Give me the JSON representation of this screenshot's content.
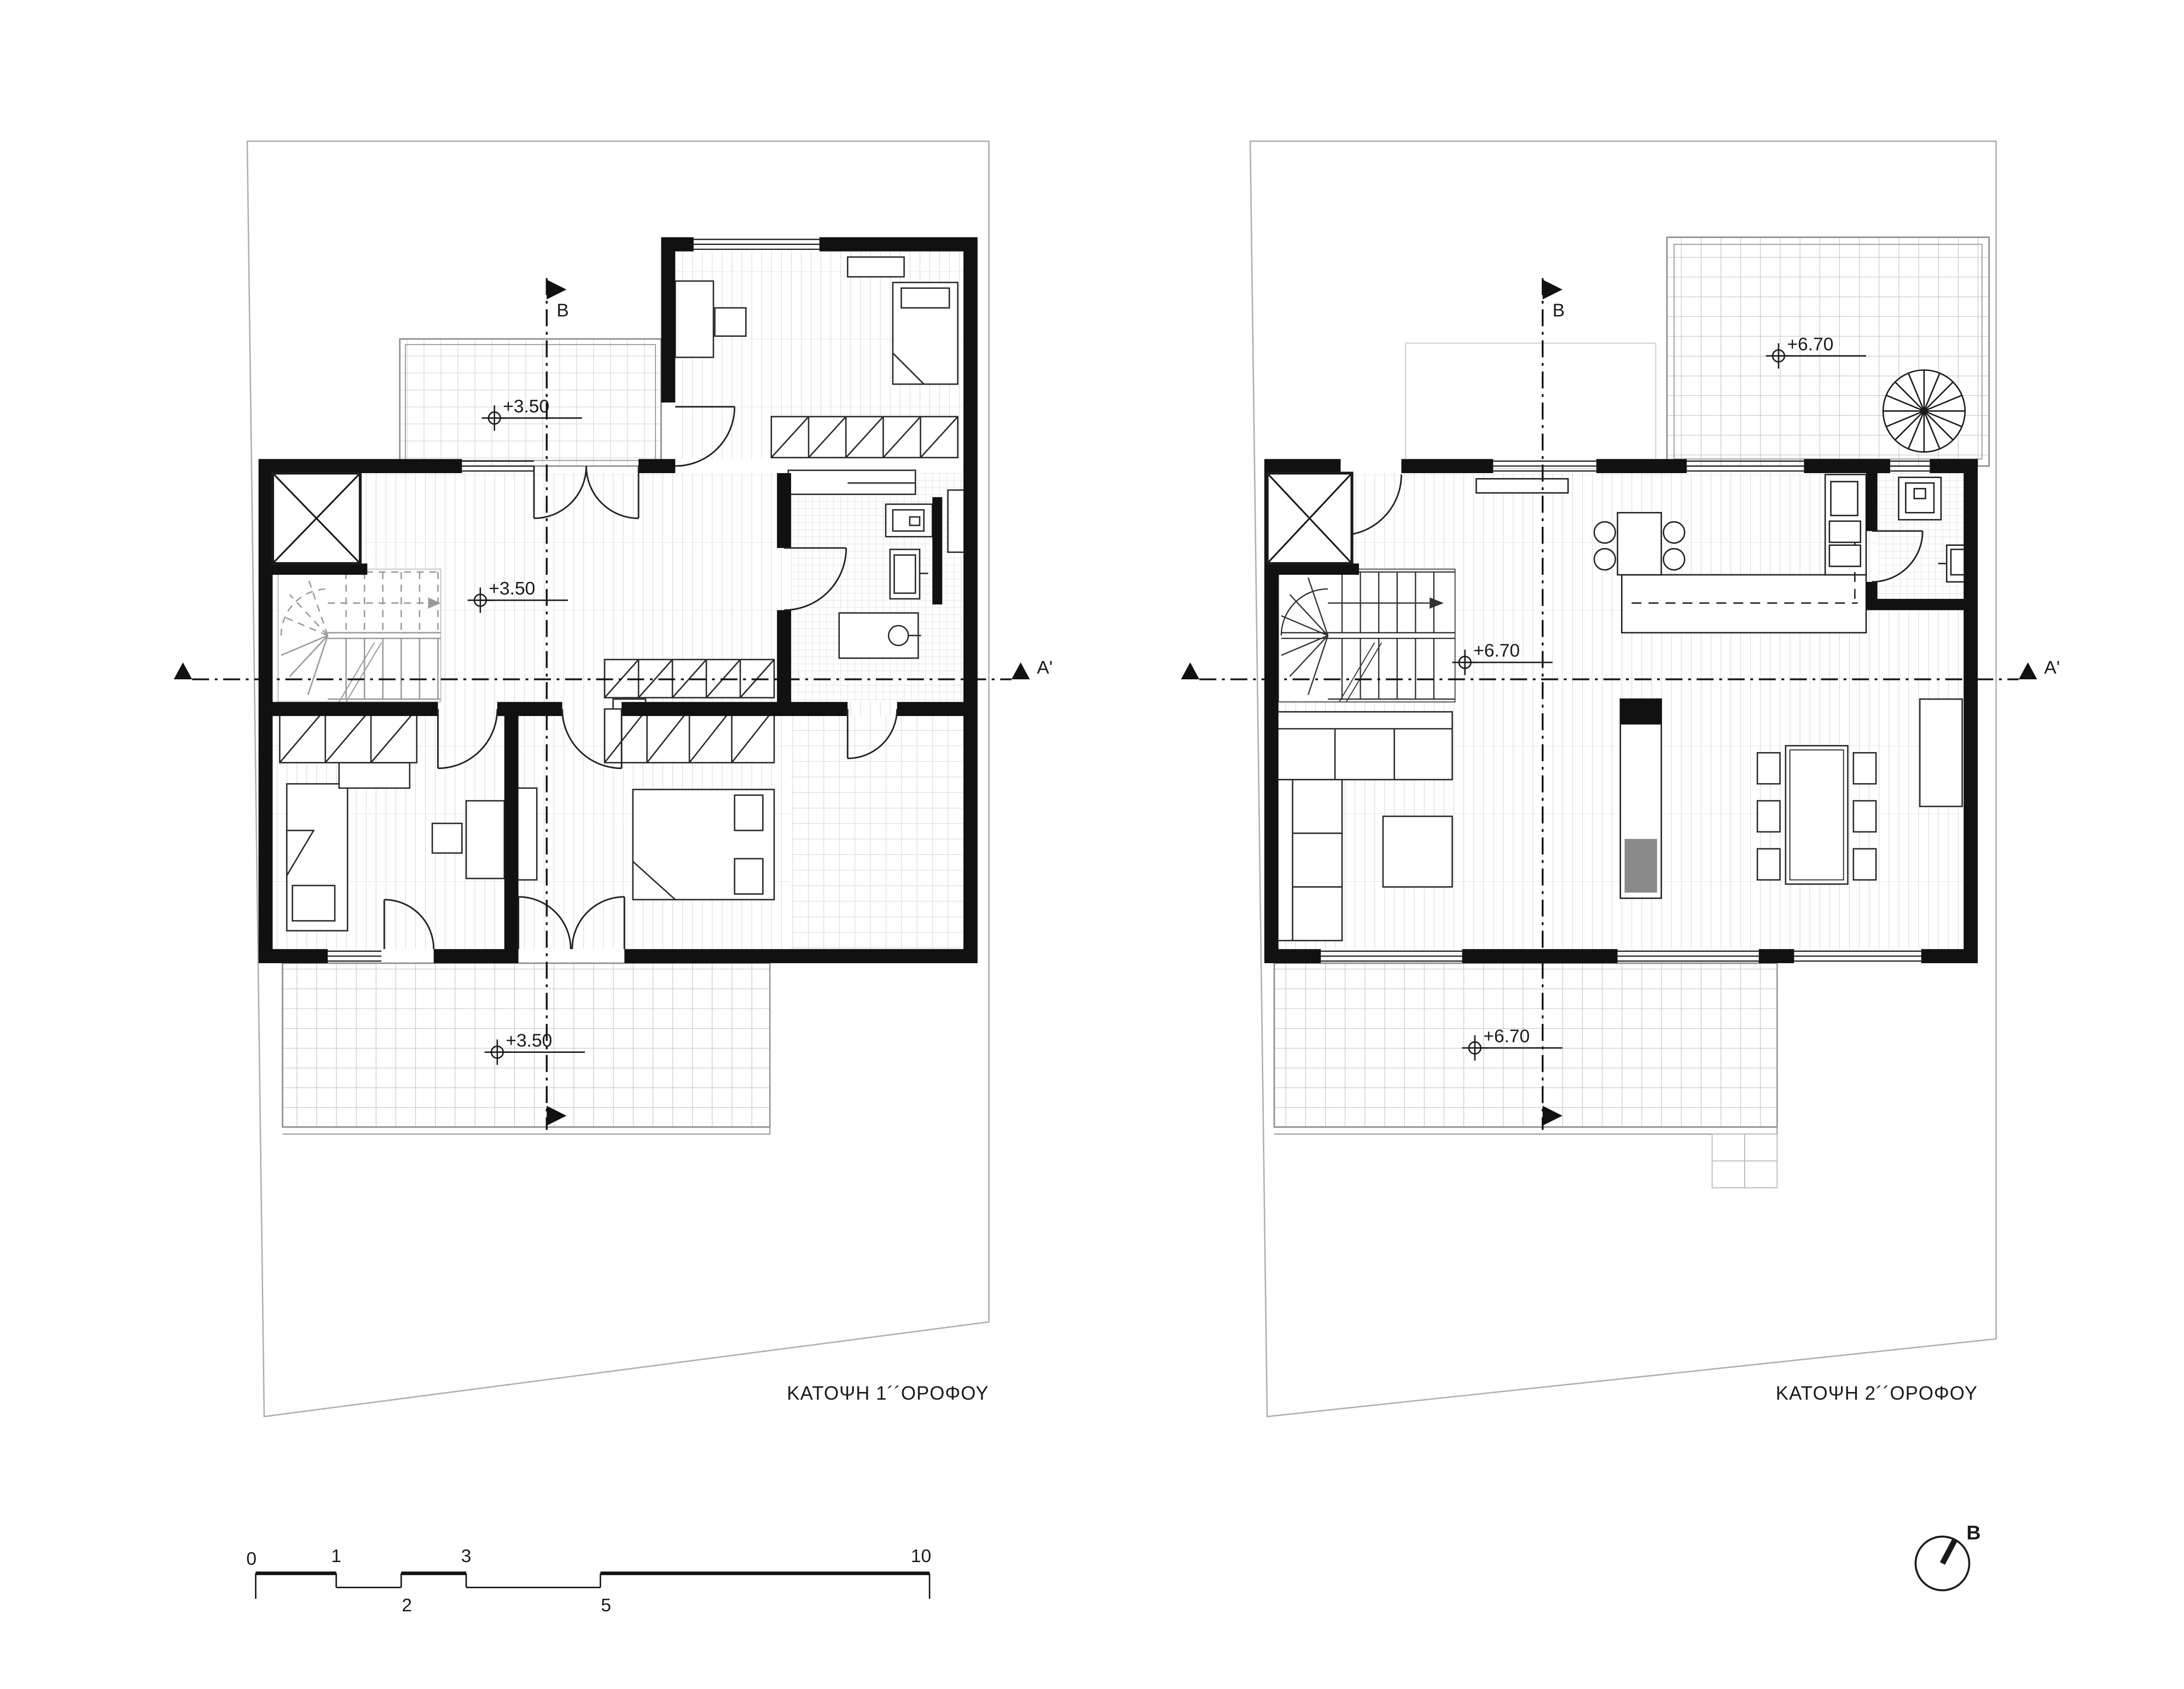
{
  "sheet": {
    "left_plan": {
      "title": "ΚΑΤΟΨΗ 1´´ΟΡΟΦΟΥ",
      "level": "+3.50",
      "section_b": "B",
      "section_a_end": "A'"
    },
    "right_plan": {
      "title": "ΚΑΤΟΨΗ 2´´ΟΡΟΦΟΥ",
      "level": "+6.70",
      "section_b": "B",
      "section_a_end": "A'"
    },
    "scale_bar": {
      "ticks": [
        "0",
        "1",
        "2",
        "3",
        "5",
        "10"
      ]
    },
    "north_arrow": {
      "label": "B"
    },
    "colors": {
      "line": "#1a1a1a",
      "wall": "#111111",
      "grid": "#bdbdbd",
      "stair_gray": "#9b9b9b",
      "fireplace_gray": "#8a8a8a"
    }
  }
}
